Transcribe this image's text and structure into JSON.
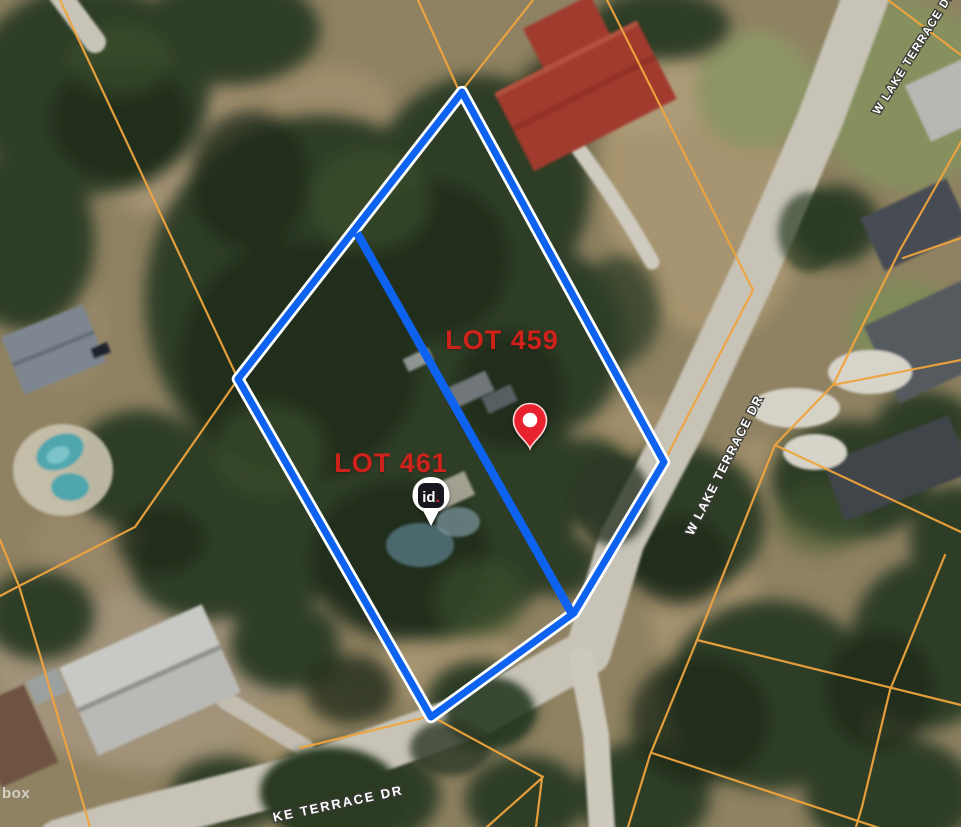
{
  "map": {
    "type": "satellite-parcel-view",
    "lots": [
      {
        "label": "LOT 459"
      },
      {
        "label": "LOT 461"
      }
    ],
    "streets": {
      "right": "W LAKE TERRACE DR",
      "top_right": "W LAKE TERRACE DR",
      "bottom": "KE TERRACE DR"
    },
    "markers": {
      "location_pin": {
        "color": "#e8222e"
      },
      "id_pin": {
        "text": "id",
        "dot": "."
      }
    },
    "attribution_partial": "box",
    "colors": {
      "parcel_line": "#efa43e",
      "boundary_blue": "#0e62f0",
      "boundary_casing": "#ffffff",
      "lot_label": "#cf221a"
    }
  }
}
